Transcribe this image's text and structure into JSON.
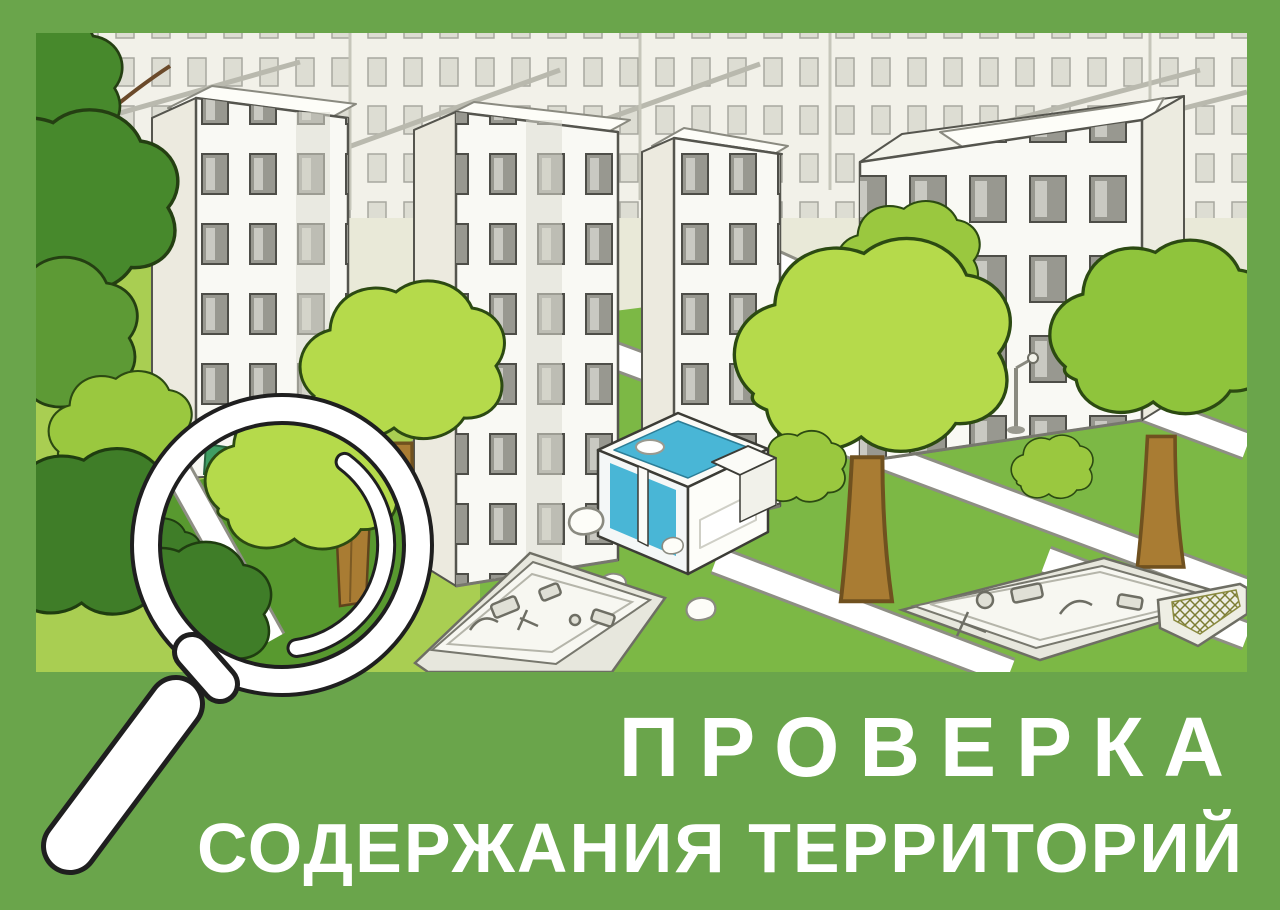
{
  "poster": {
    "title_line1": "ПРОВЕРКА",
    "title_line2": "СОДЕРЖАНИЯ ТЕРРИТОРИЙ"
  },
  "icons": {
    "magnifier": "magnifier-icon"
  },
  "colors": {
    "frame_green": "#6aa54b",
    "sky_beige": "#e9e9d8",
    "backdrop_buildings": "#f2f1e9",
    "lawn_green": "#7cb845",
    "bright_lawn_green": "#a9ce52",
    "lens_lawn_green": "#58992f",
    "tree_bright_green": "#b5da4b",
    "tree_mid_green": "#9ac83f",
    "foliage_dark_green": "#47892c",
    "trunk_brown": "#a97c33",
    "building_white": "#f9f9f4",
    "window_gray": "#989890",
    "path_white": "#ffffff",
    "pavilion_cyan": "#49b6d6",
    "accent_teal": "#3f9e63",
    "outline_dark": "#1f1f1f",
    "text_white": "#ffffff"
  }
}
